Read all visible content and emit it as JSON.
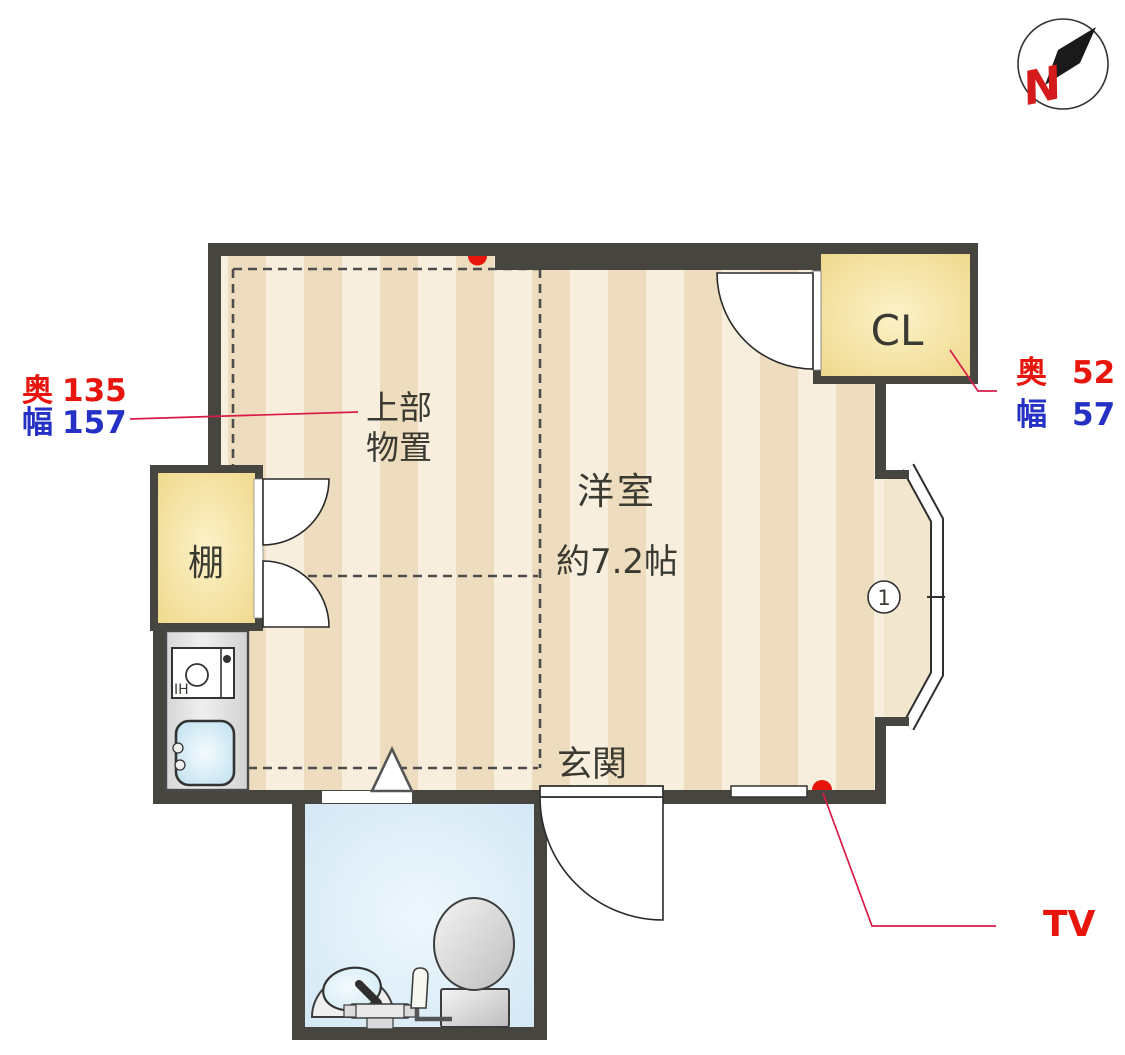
{
  "compass": {
    "north_label": "N"
  },
  "rooms": {
    "main_room": {
      "name": "洋室",
      "size": "約7.2帖"
    },
    "entrance": {
      "name": "玄関"
    },
    "closet": {
      "name": "CL"
    },
    "shelf": {
      "name": "棚"
    },
    "upper_storage": {
      "line1": "上部",
      "line2": "物置"
    },
    "stove_label": "IH"
  },
  "dimensions": {
    "upper_storage": {
      "depth_label": "奥",
      "depth_value": "135",
      "width_label": "幅",
      "width_value": "157"
    },
    "closet": {
      "depth_label": "奥",
      "depth_value": "52",
      "width_label": "幅",
      "width_value": "57"
    }
  },
  "annotations": {
    "tv_label": "TV",
    "window_number": "1"
  },
  "colors": {
    "wall": "#47453f",
    "floor_light": "#f8eedd",
    "floor_dark": "#eddcbd",
    "bay_floor": "#f3e6cf",
    "storage_yellow_edge": "#f0d98e",
    "storage_yellow_center": "#fcf2c8",
    "bath_blue_edge": "#d2e7f4",
    "bath_blue_center": "#eef7fd",
    "text_red": "#e8150c",
    "text_blue": "#2531c4",
    "leader_red": "#d81b47"
  }
}
